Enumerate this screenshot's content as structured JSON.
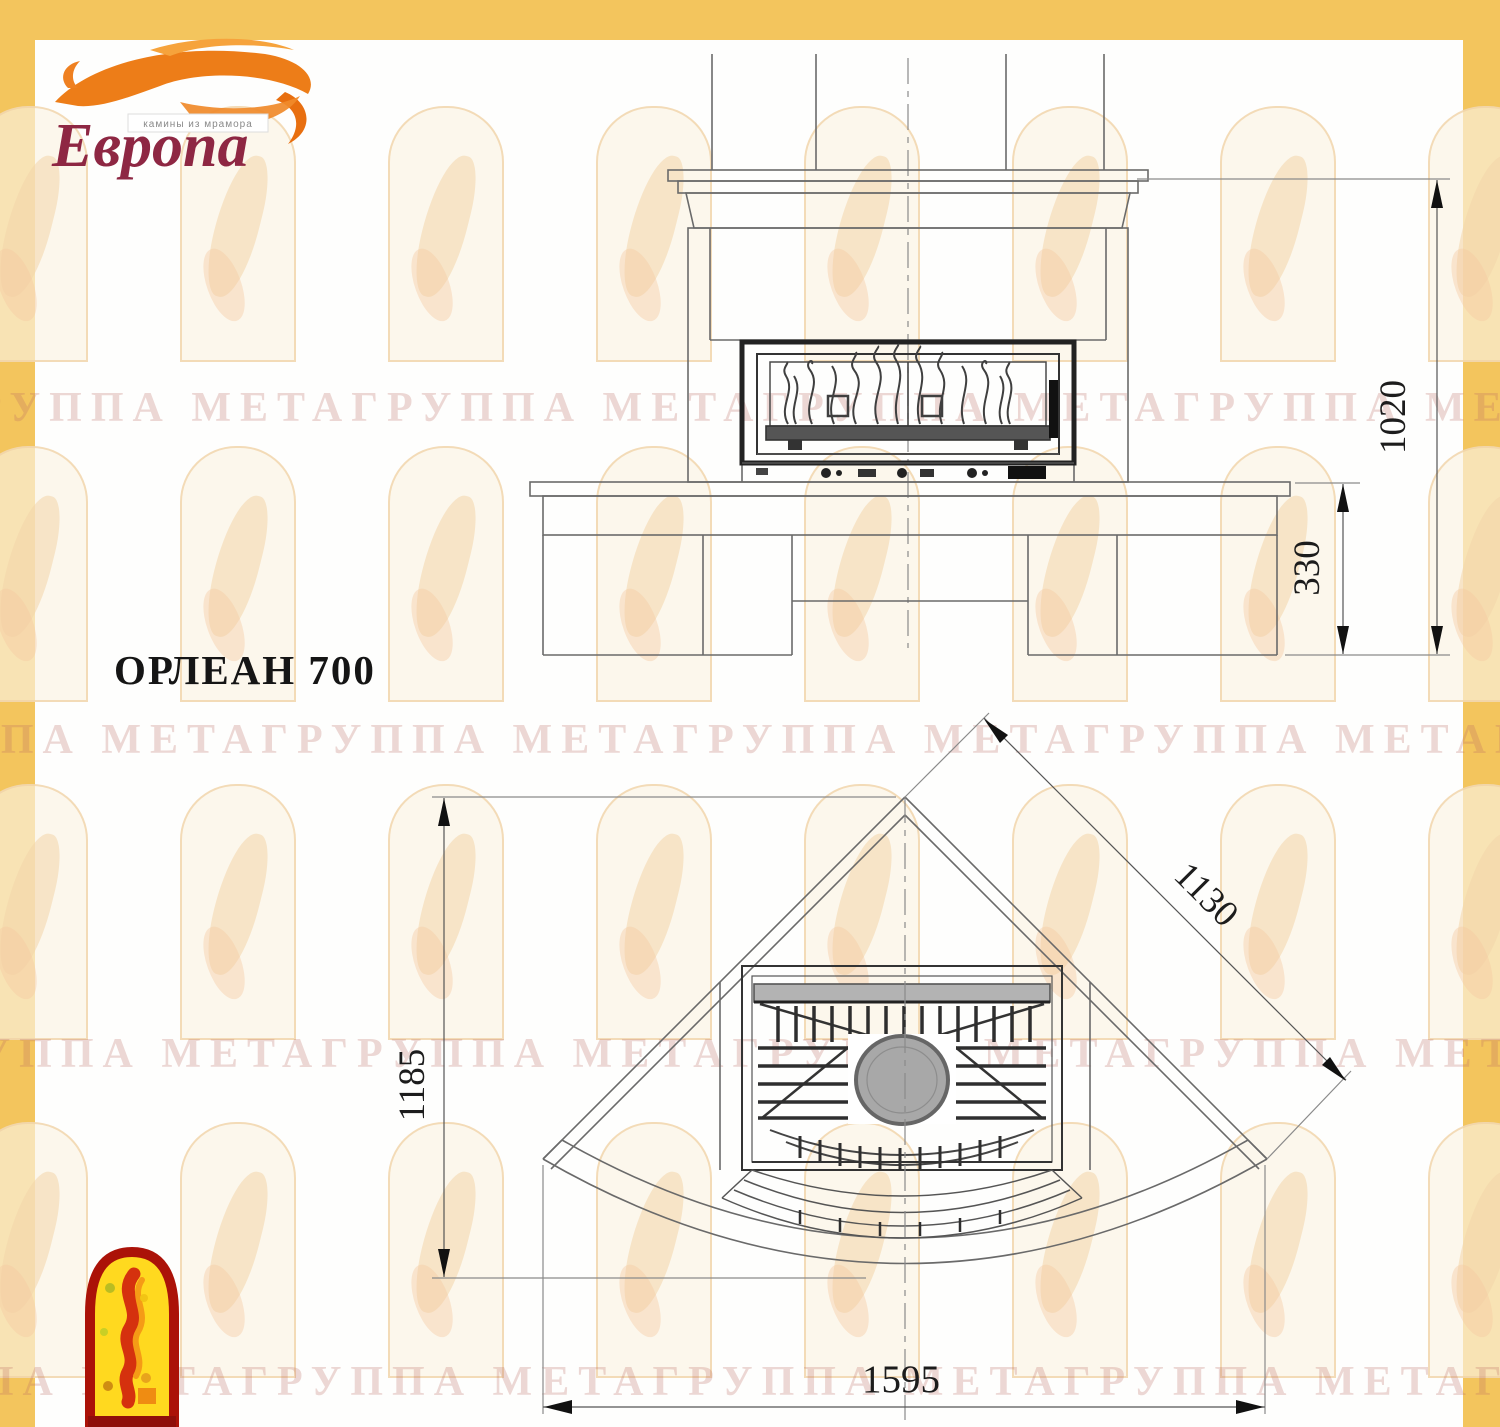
{
  "page": {
    "background": "#fefefd",
    "frame_color": "#f3c55d"
  },
  "brand": {
    "name": "Европа",
    "tagline": "камины из мрамора",
    "flame_color": "#ed7d18",
    "name_color": "#8e2743"
  },
  "watermark": {
    "text": "ГРУППА МЕТАГРУППА МЕТАГРУППА МЕТАГРУППА МЕТАГРУППА МЕТА",
    "color": "rgba(186,106,96,0.26)"
  },
  "title": "ОРЛЕАН 700",
  "drawing": {
    "front_view": {
      "height_total_mm": "1020",
      "base_height_mm": "330"
    },
    "plan_view": {
      "depth_mm": "1185",
      "diagonal_mm": "1130",
      "width_mm": "1595"
    }
  }
}
